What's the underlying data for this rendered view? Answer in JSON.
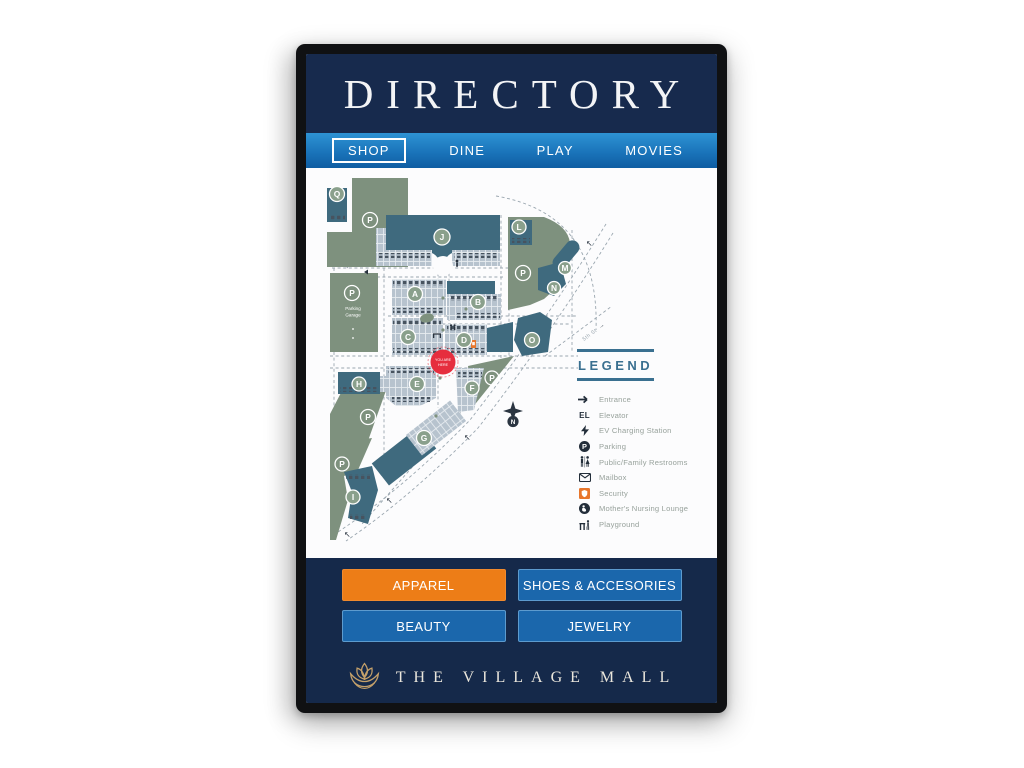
{
  "kiosk": {
    "title": "DIRECTORY",
    "tabs": [
      {
        "label": "SHOP",
        "active": true
      },
      {
        "label": "DINE",
        "active": false
      },
      {
        "label": "PLAY",
        "active": false
      },
      {
        "label": "MOVIES",
        "active": false
      }
    ],
    "map": {
      "badges": {
        "q": "Q",
        "j": "J",
        "l": "L",
        "m": "M",
        "n": "N",
        "a": "A",
        "b": "B",
        "c": "C",
        "d": "D",
        "o": "O",
        "h": "H",
        "e": "E",
        "f": "F",
        "g": "G",
        "i": "I"
      },
      "parking_letter": "P",
      "parking_garage": [
        "Parking",
        "Garage"
      ],
      "you_are_here": [
        "YOU ARE",
        "HERE"
      ],
      "street": {
        "label": "5th St",
        "arrow": "→"
      },
      "compass": "N",
      "legend": {
        "title": "LEGEND",
        "items": [
          {
            "icon": "entrance-arrow-icon",
            "label": "Entrance"
          },
          {
            "icon": "elevator-el-icon",
            "icon_text": "EL",
            "label": "Elevator"
          },
          {
            "icon": "ev-charging-icon",
            "label": "EV Charging Station"
          },
          {
            "icon": "parking-icon",
            "label": "Parking"
          },
          {
            "icon": "restrooms-icon",
            "label": "Public/Family Restrooms"
          },
          {
            "icon": "mailbox-icon",
            "label": "Mailbox"
          },
          {
            "icon": "security-icon",
            "label": "Security"
          },
          {
            "icon": "nursing-icon",
            "label": "Mother's Nursing Lounge"
          },
          {
            "icon": "playground-icon",
            "label": "Playground"
          }
        ]
      }
    },
    "categories": [
      {
        "label": "APPAREL",
        "active": true
      },
      {
        "label": "SHOES & ACCESORIES",
        "active": false
      },
      {
        "label": "BEAUTY",
        "active": false
      },
      {
        "label": "JEWELRY",
        "active": false
      }
    ],
    "brand": {
      "name": "THE VILLAGE MALL"
    },
    "colors": {
      "header_navy": "#172a4d",
      "footer_navy": "#15294a",
      "tab_blue_top": "#2e93d4",
      "tab_blue_bottom": "#0f5da2",
      "button_blue": "#1b67ac",
      "button_border": "#5d9bce",
      "active_orange": "#ed7d17",
      "map_green": "#7e917e",
      "map_teal": "#3f6a7e",
      "map_gray": "#b7c3ce",
      "badge_green": "#8aa08c",
      "you_are_here_red": "#e62e3e",
      "security_orange": "#e8762c",
      "legend_teal": "#3a7090",
      "legend_text_gray": "#98a29c",
      "road_gray": "#9aa6af",
      "brand_gold": "#c4a06a"
    }
  }
}
